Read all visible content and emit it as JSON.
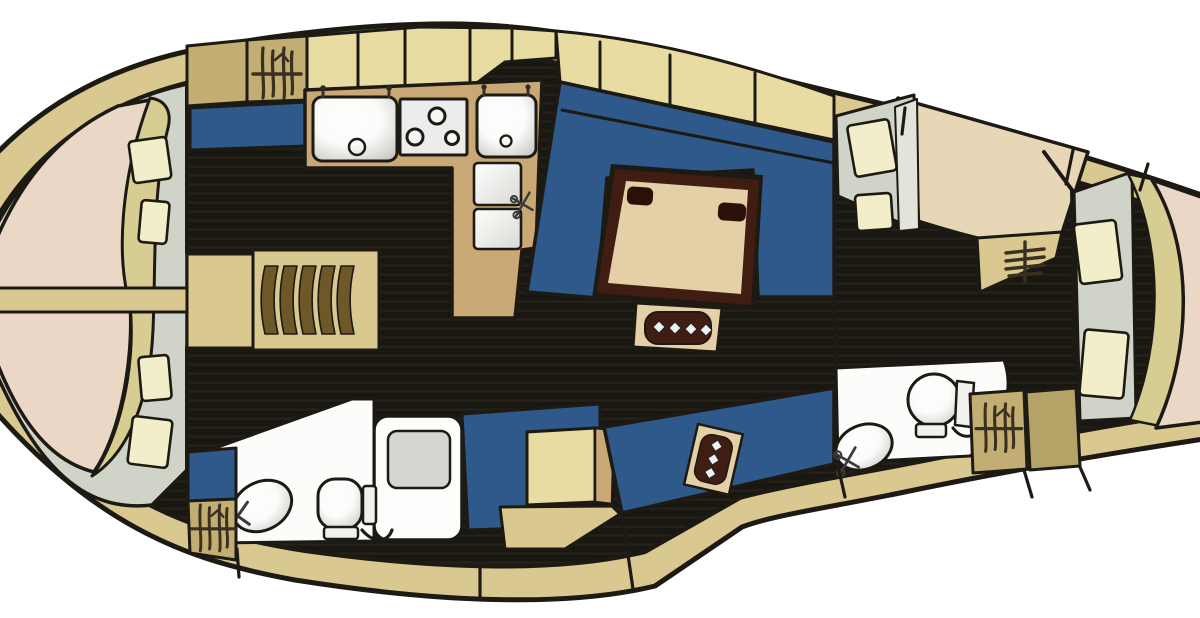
{
  "diagram": {
    "kind": "sailing-yacht-interior-floor-plan",
    "view": "top-down",
    "bow_side": "left",
    "stern_side": "right"
  },
  "areas": [
    {
      "name": "forward-owner-cabin",
      "features": [
        "v-berth-double-bed",
        "blanket-fold",
        "pillows",
        "entry-steps",
        "hanging-locker"
      ]
    },
    {
      "name": "galley",
      "features": [
        "large-sink",
        "three-burner-stove",
        "second-sink",
        "refrigerator-lids",
        "mixer-tap",
        "l-shaped-counter"
      ]
    },
    {
      "name": "salon",
      "features": [
        "u-shaped-settee",
        "dining-table",
        "cup-holders",
        "bottle-holder",
        "straight-settee"
      ]
    },
    {
      "name": "nav-station",
      "features": [
        "seat",
        "chart-table"
      ]
    },
    {
      "name": "forward-head",
      "features": [
        "toilet",
        "washbasin",
        "mixer-tap",
        "shower-stall",
        "hanging-locker"
      ]
    },
    {
      "name": "aft-head",
      "features": [
        "toilet",
        "washbasin",
        "mixer-tap",
        "hanging-locker"
      ]
    },
    {
      "name": "starboard-aft-cabin",
      "features": [
        "double-berth",
        "pillows"
      ]
    },
    {
      "name": "aft-owner-cabin",
      "features": [
        "double-berth",
        "pillows",
        "locker",
        "blanket-fold"
      ]
    },
    {
      "name": "companionway",
      "features": [
        "steps-symbol"
      ]
    }
  ],
  "counts": {
    "forward_berth_pillows": 4,
    "starboard_berth_pillows": 2,
    "aft_berth_pillows": 2,
    "stove_burners": 3,
    "table_cup_holders": 2,
    "table_bottle_slots": 4,
    "settee_bottle_slots": 3,
    "forward_cabin_step_slats": 5,
    "companionway_step_rungs": 4,
    "hanging_lockers": 3
  },
  "palette": {
    "outline": "#1d1a14",
    "exterior": "#ffffff",
    "deck": "#d9c890",
    "locker_cream": "#e8dca3",
    "cabinet_khaki": "#c2ad72",
    "counter_tan": "#c9a876",
    "upholstery_blue": "#2e598a",
    "floor_dark": "#191712",
    "floor_stripe": "#262219",
    "mattress_pink": "#ead7c6",
    "blanket_khaki": "#d7cc91",
    "bedding_grey": "#cfd3c8",
    "bedding_light": "#e2e4dc",
    "pillow_cream": "#f3eeca",
    "table_top": "#e4cfa6",
    "table_frame": "#401d12",
    "shower_grey": "#d4d6cf",
    "steps_brown": "#6f5827",
    "locker_dark": "#b5a267",
    "symbol_dark": "#3a3020"
  }
}
